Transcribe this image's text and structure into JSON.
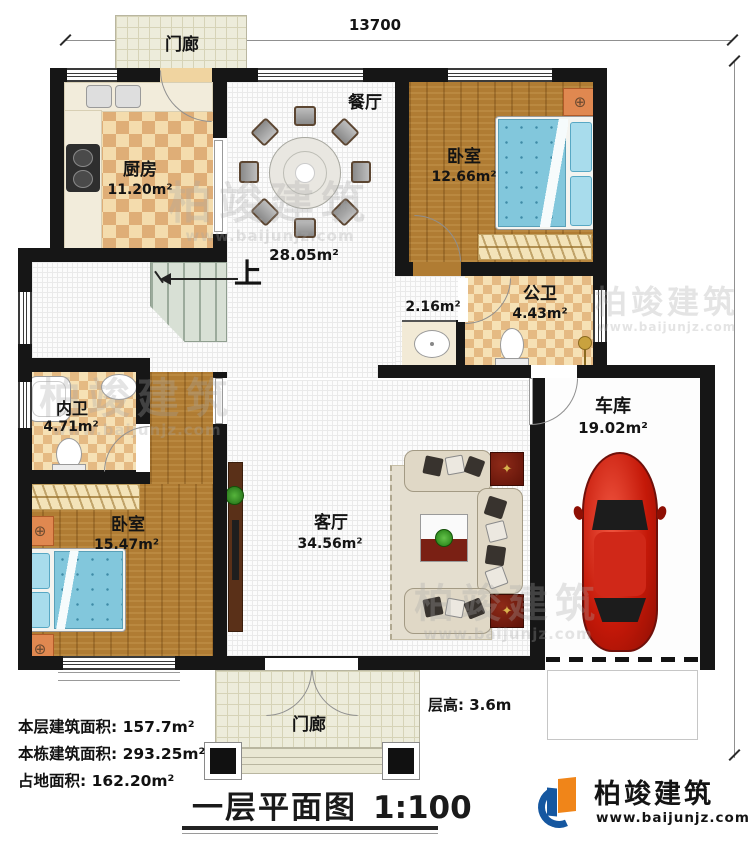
{
  "dimensions": {
    "top": "13700",
    "right": "13620"
  },
  "rooms": {
    "porch_top": {
      "name": "门廊"
    },
    "kitchen": {
      "name": "厨房",
      "area": "11.20m²"
    },
    "dining": {
      "name": "餐厅"
    },
    "hall": {
      "area": "28.05m²"
    },
    "stairs": {
      "up": "上"
    },
    "bedroom_top": {
      "name": "卧室",
      "area": "12.66m²"
    },
    "public_bath": {
      "name": "公卫",
      "area": "4.43m²"
    },
    "wash_area": {
      "area": "2.16m²"
    },
    "inner_bath": {
      "name": "内卫",
      "area": "4.71m²"
    },
    "bedroom_left": {
      "name": "卧室",
      "area": "15.47m²"
    },
    "living": {
      "name": "客厅",
      "area": "34.56m²"
    },
    "garage": {
      "name": "车库",
      "area": "19.02m²"
    },
    "porch_bottom": {
      "name": "门廊"
    }
  },
  "notes": {
    "floor_height": "层高: 3.6m"
  },
  "stats": {
    "line1": "本层建筑面积: 157.7m²",
    "line2": "本栋建筑面积: 293.25m²",
    "line3": "占地面积: 162.20m²"
  },
  "title_block": {
    "title": "一层平面图",
    "scale": "1:100"
  },
  "brand": {
    "name": "柏竣建筑",
    "url": "www.baijunjz.com"
  },
  "watermark": {
    "text": "柏竣建筑",
    "url": "www.baijunjz.com"
  },
  "colors": {
    "wall": "#161616",
    "wood": "#b07c33",
    "checker": "#dfae77",
    "bed": "#82c7dc",
    "car": "#c41808",
    "accent_orange": "#f08519",
    "accent_blue": "#1557a0"
  }
}
